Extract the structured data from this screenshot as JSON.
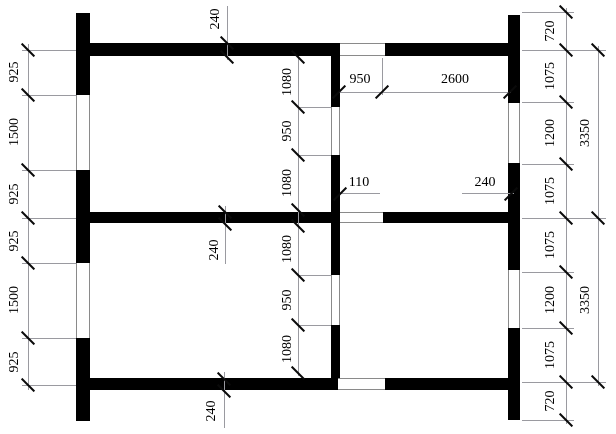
{
  "plan": {
    "left_chain": [
      "925",
      "1500",
      "925",
      "925",
      "1500",
      "925"
    ],
    "right_inner_chain": [
      "720",
      "1075",
      "1200",
      "1075",
      "1075",
      "1200",
      "1075",
      "720"
    ],
    "right_outer_chain": [
      "3350",
      "3350"
    ],
    "mid_chain_upper": [
      "1080",
      "950",
      "1080"
    ],
    "mid_chain_lower": [
      "1080",
      "950",
      "1080"
    ],
    "top_room_chain": [
      "950",
      "2600"
    ],
    "thickness_labels": {
      "top_wall": "240",
      "mid_wall": "240",
      "bottom_wall": "240",
      "partition": "110",
      "right_wall": "240"
    }
  }
}
